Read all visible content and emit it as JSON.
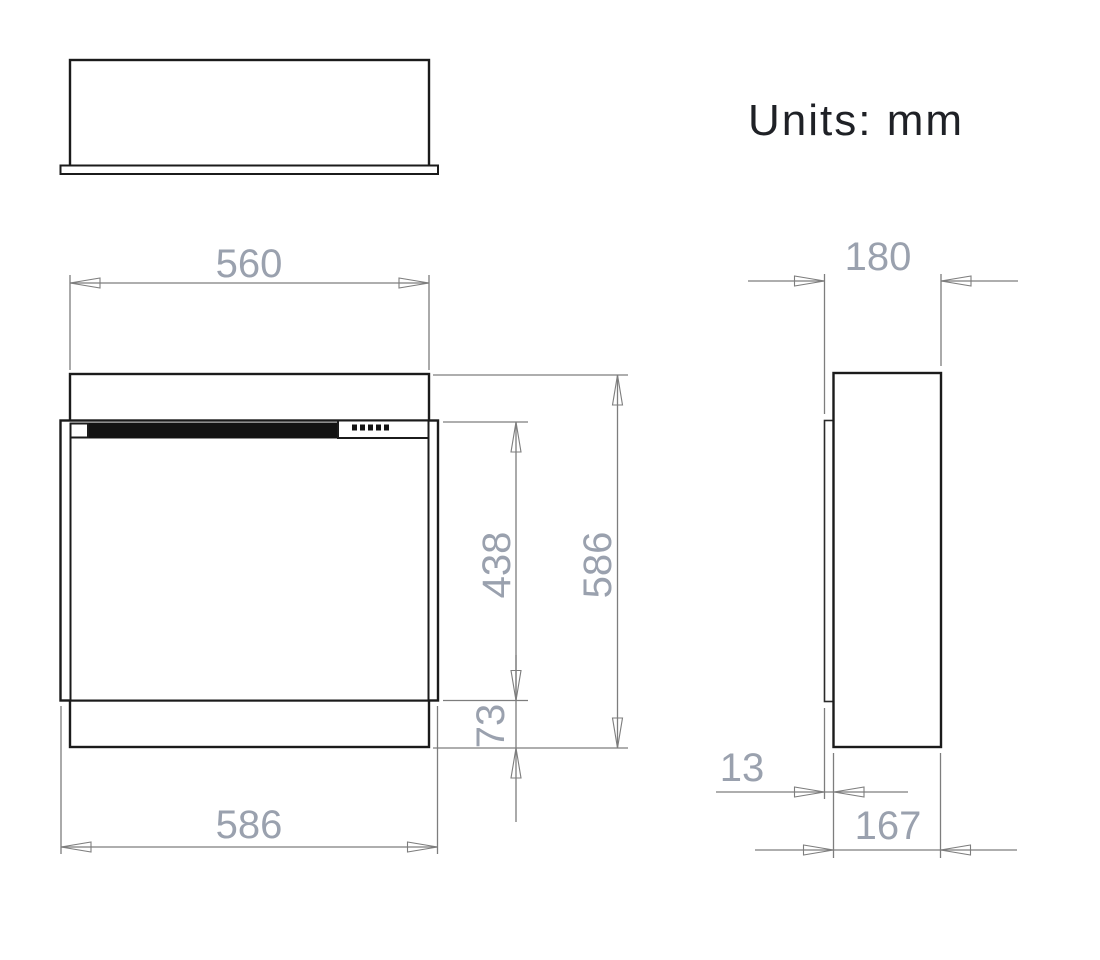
{
  "units_label": "Units: mm",
  "front_view": {
    "dims": {
      "body_width": "560",
      "overall_width": "586",
      "glass_section_height": "438",
      "overall_height": "586",
      "base_section_height": "73"
    }
  },
  "side_view": {
    "dims": {
      "overall_depth": "180",
      "front_flange_depth": "13",
      "body_depth": "167"
    }
  },
  "colors": {
    "outline": "#1b1b1b",
    "dimension_line": "#7d7d7d",
    "dimension_text": "#9aa1ae",
    "label_text": "#1f2126",
    "background": "#ffffff"
  }
}
